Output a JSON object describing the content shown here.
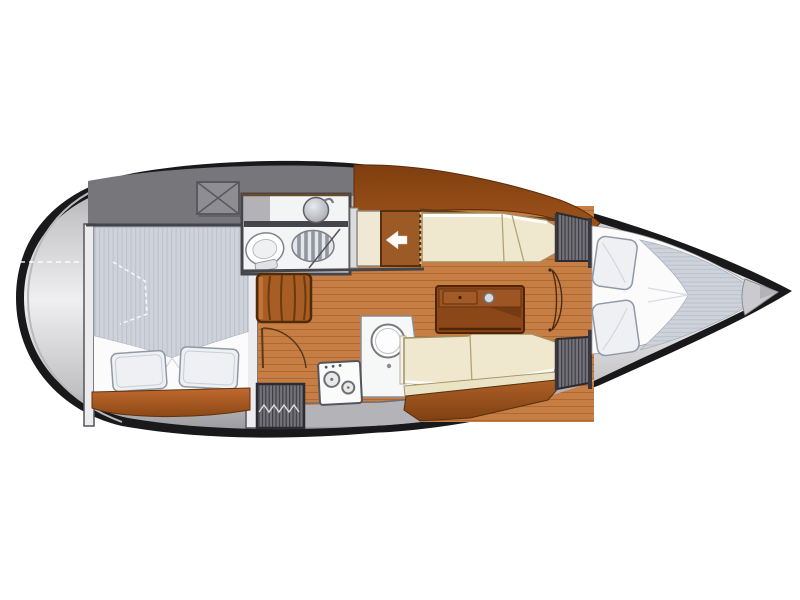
{
  "diagram": {
    "type": "sailboat-interior-floor-plan",
    "orientation": "bow-right-stern-left",
    "background_color": "#ffffff",
    "areas": [
      {
        "id": "stern-deck",
        "label": "stern transom deck"
      },
      {
        "id": "aft-cabin",
        "label": "aft double cabin with transverse berth, two pillows and step shelf"
      },
      {
        "id": "cockpit-locker",
        "label": "cockpit area with crossed hatch box"
      },
      {
        "id": "head",
        "label": "head compartment with washbasin, marine toilet and shower grating"
      },
      {
        "id": "companionway",
        "label": "companionway entry marked with white arrow and dotted hatch line"
      },
      {
        "id": "steps",
        "label": "companionway steps beside aft cabin door"
      },
      {
        "id": "engine-hatch",
        "label": "hatched engine / storage compartment"
      },
      {
        "id": "galley",
        "label": "galley with two-burner stove and round sink counter"
      },
      {
        "id": "saloon",
        "label": "saloon with centre table, port settee and starboard settee"
      },
      {
        "id": "forward-cabin",
        "label": "forward V-berth cabin with two pillows"
      },
      {
        "id": "wardrobes",
        "label": "hatched hanging lockers either side of forward door"
      },
      {
        "id": "anchor-locker",
        "label": "anchor locker wedge at bow"
      }
    ],
    "entry_arrow": {
      "glyph": "◄",
      "direction": "left",
      "meaning": "companionway entrance"
    },
    "hatch_marker": {
      "glyph": "✕",
      "meaning": "cockpit locker lid"
    }
  },
  "palette": {
    "hullDark": "#19191b",
    "deckTop": "#98989c",
    "deckHi": "#efeff1",
    "deckLo": "#939397",
    "wall": "#45444a",
    "wallLight": "#ececee",
    "wood": "#c67e45",
    "woodLine": "#a5602c",
    "bandDark": "#7e3e10",
    "band": "#a2551c",
    "stepBrown": "#a85d24",
    "entryBrown": "#9c5a26",
    "furniture": "#8b4718",
    "furnitureEdge": "#4f2506",
    "cream": "#efe8cf",
    "creamEdge": "#a39060",
    "creamBack": "#ebe3c6",
    "white": "#fbfbfc",
    "mattress": "#ced3db",
    "mattressLine": "#bdc3cf",
    "pillow": "#eef0f4",
    "pillowEdge": "#9099a5",
    "grayBand": "#77767b",
    "hatch": "#74737a",
    "hatchLine": "#3e3d43",
    "orangeBase": "#b06028",
    "metalHi": "#e8eaec",
    "metalLo": "#9fa4aa"
  }
}
